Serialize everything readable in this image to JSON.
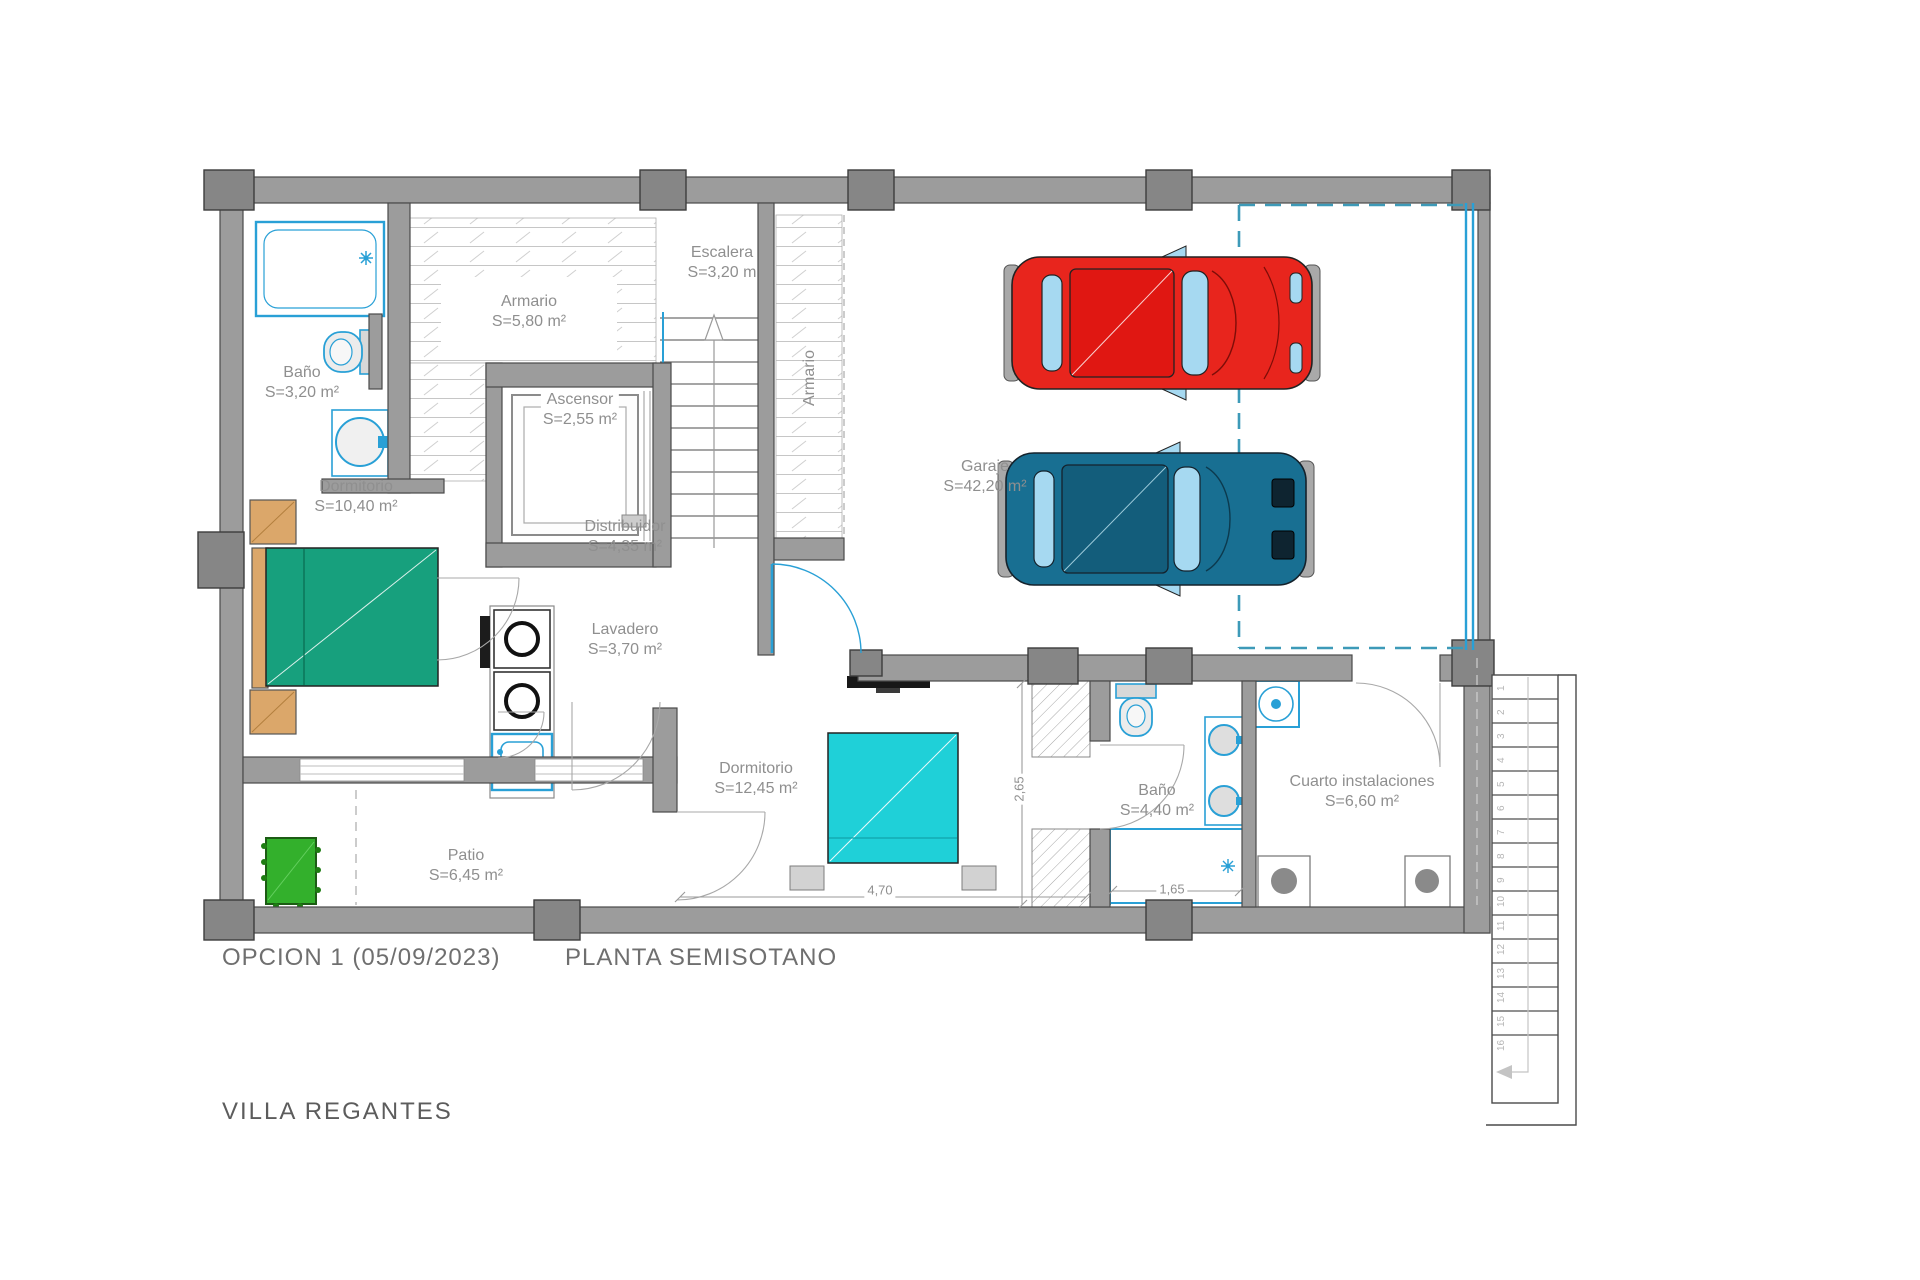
{
  "document": {
    "option_label": "OPCION 1 (05/09/2023)",
    "plan_title": "PLANTA SEMISOTANO",
    "project_name": "VILLA REGANTES"
  },
  "rooms": {
    "bano1": {
      "name": "Baño",
      "area": "S=3,20 m²"
    },
    "armario1": {
      "name": "Armario",
      "area": "S=5,80 m²"
    },
    "escalera": {
      "name": "Escalera",
      "area": "S=3,20 m"
    },
    "ascensor": {
      "name": "Ascensor",
      "area": "S=2,55 m²"
    },
    "armario2": {
      "name": "Armario"
    },
    "garaje": {
      "name": "Garaje",
      "area": "S=42,20 m²"
    },
    "dormitorio1": {
      "name": "Dormitorio",
      "area": "S=10,40 m²"
    },
    "distribuidor": {
      "name": "Distribuidor",
      "area": "S=4,35 m²"
    },
    "lavadero": {
      "name": "Lavadero",
      "area": "S=3,70 m²"
    },
    "dormitorio2": {
      "name": "Dormitorio",
      "area": "S=12,45 m²"
    },
    "bano2": {
      "name": "Baño",
      "area": "S=4,40 m²"
    },
    "cuarto": {
      "name": "Cuarto instalaciones",
      "area": "S=6,60 m²"
    },
    "patio": {
      "name": "Patio",
      "area": "S=6,45 m²"
    }
  },
  "dimensions": {
    "dorm2_width": "4,70",
    "bano2_depth": "2,65",
    "bano2_width": "1,65"
  },
  "exterior_stair_step_numbers": [
    "1",
    "2",
    "3",
    "4",
    "5",
    "6",
    "7",
    "8",
    "9",
    "10",
    "11",
    "12",
    "13",
    "14",
    "15",
    "16"
  ],
  "colors": {
    "wall_grey": "#9c9c9c",
    "fixture_cyan": "#29a0d6",
    "garage_boundary_teal": "#3d9ab8",
    "bed1_green": "#17a07d",
    "bed2_turquoise": "#1fd0d8",
    "furniture_orange": "#dba76a",
    "plant_green": "#33b02c",
    "car_red": "#e8251d",
    "car_blue": "#186f92",
    "window_blue": "#a6d9f1",
    "label_grey": "#8f8f8f"
  }
}
